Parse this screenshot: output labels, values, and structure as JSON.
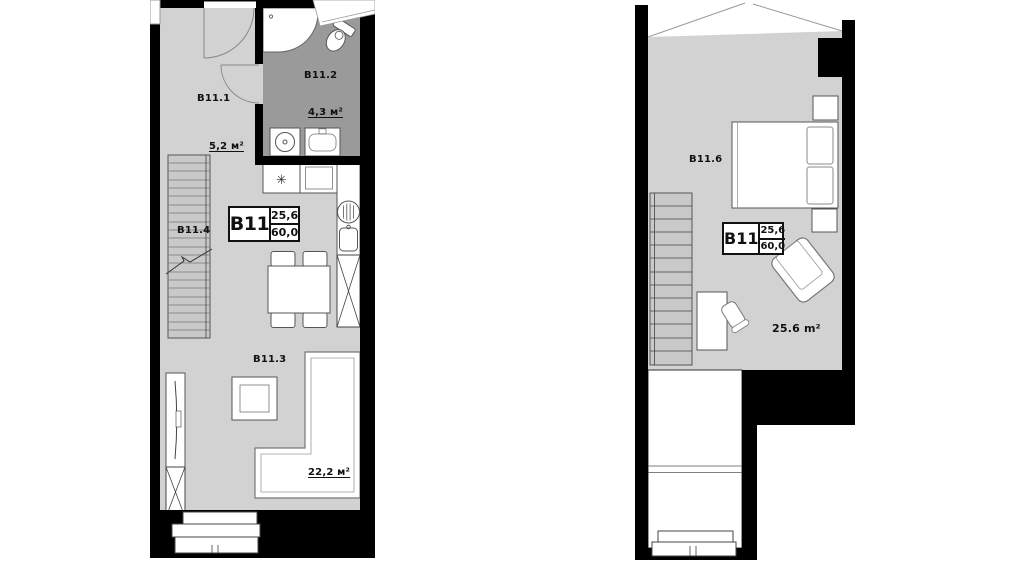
{
  "unit_label": {
    "id": "B11",
    "value_top": "25,6",
    "value_bottom": "60,0"
  },
  "floor1": {
    "hall": {
      "id": "B11.1",
      "area": "5,2 м²"
    },
    "bath": {
      "id": "B11.2",
      "area": "4,3 м²"
    },
    "living": {
      "id": "B11.3",
      "area": "22,2 м²"
    },
    "stairs": {
      "id": "B11.4"
    }
  },
  "floor2": {
    "bedroom": {
      "id": "B11.6",
      "area": "25.6 m²"
    }
  },
  "symbols": {
    "fridge": "✳"
  },
  "colors": {
    "wall": "#000000",
    "floor": "#d2d2d2",
    "bathroom_floor": "#9a9a9a",
    "stairs": "#c9c9c9"
  }
}
